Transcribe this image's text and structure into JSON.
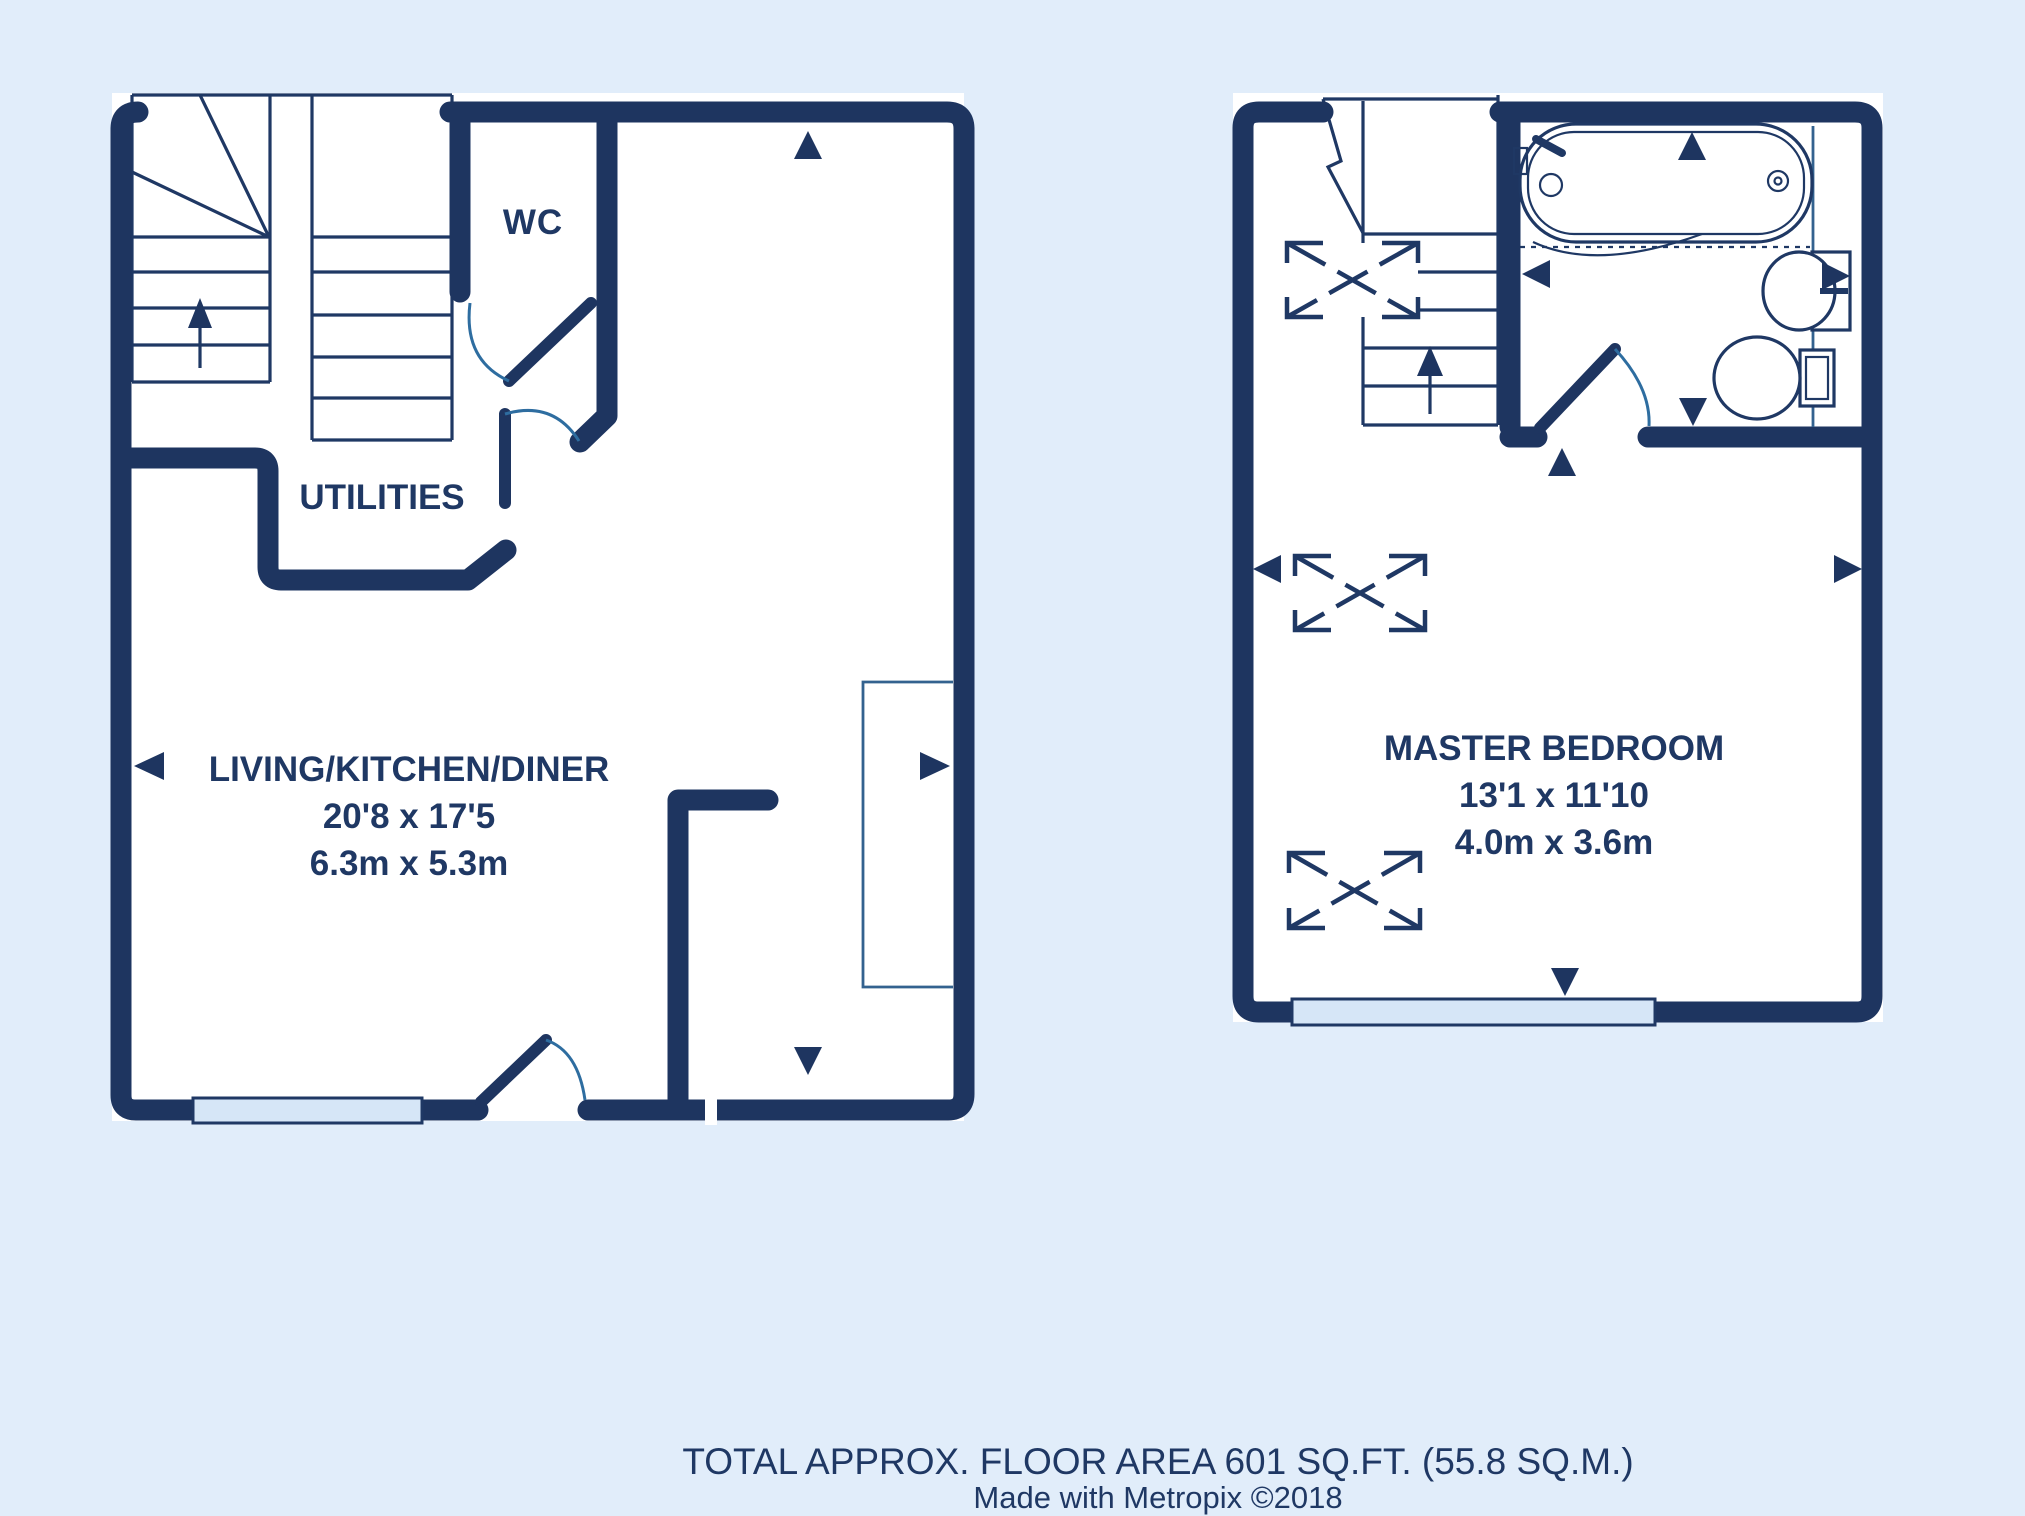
{
  "colors": {
    "wall": "#1e3560",
    "line": "#1f3864",
    "arc": "#2e6da0",
    "steel": "#33628f",
    "window": "#d6e6f7",
    "text": "#1f3864",
    "room": "#ffffff",
    "bg": "#e1edfa"
  },
  "floors": [
    {
      "name": "ground-floor",
      "rooms": [
        {
          "label": "WC"
        },
        {
          "label": "UTILITIES"
        },
        {
          "label": "LIVING/KITCHEN/DINER",
          "dim_imperial": "20'8 x 17'5",
          "dim_metric": "6.3m x 5.3m"
        }
      ],
      "features": [
        "staircase-up",
        "wc-door",
        "hall-door",
        "front-door",
        "window"
      ]
    },
    {
      "name": "first-floor",
      "rooms": [
        {
          "label": "MASTER BEDROOM",
          "dim_imperial": "13'1 x 11'10",
          "dim_metric": "4.0m x 3.6m"
        }
      ],
      "features": [
        "staircase-break",
        "bathroom",
        "bathtub",
        "sink",
        "toilet",
        "wardrobes",
        "window"
      ]
    }
  ],
  "footer": {
    "total_area": "TOTAL APPROX. FLOOR AREA 601 SQ.FT. (55.8 SQ.M.)",
    "credit": "Made with Metropix ©2018"
  }
}
